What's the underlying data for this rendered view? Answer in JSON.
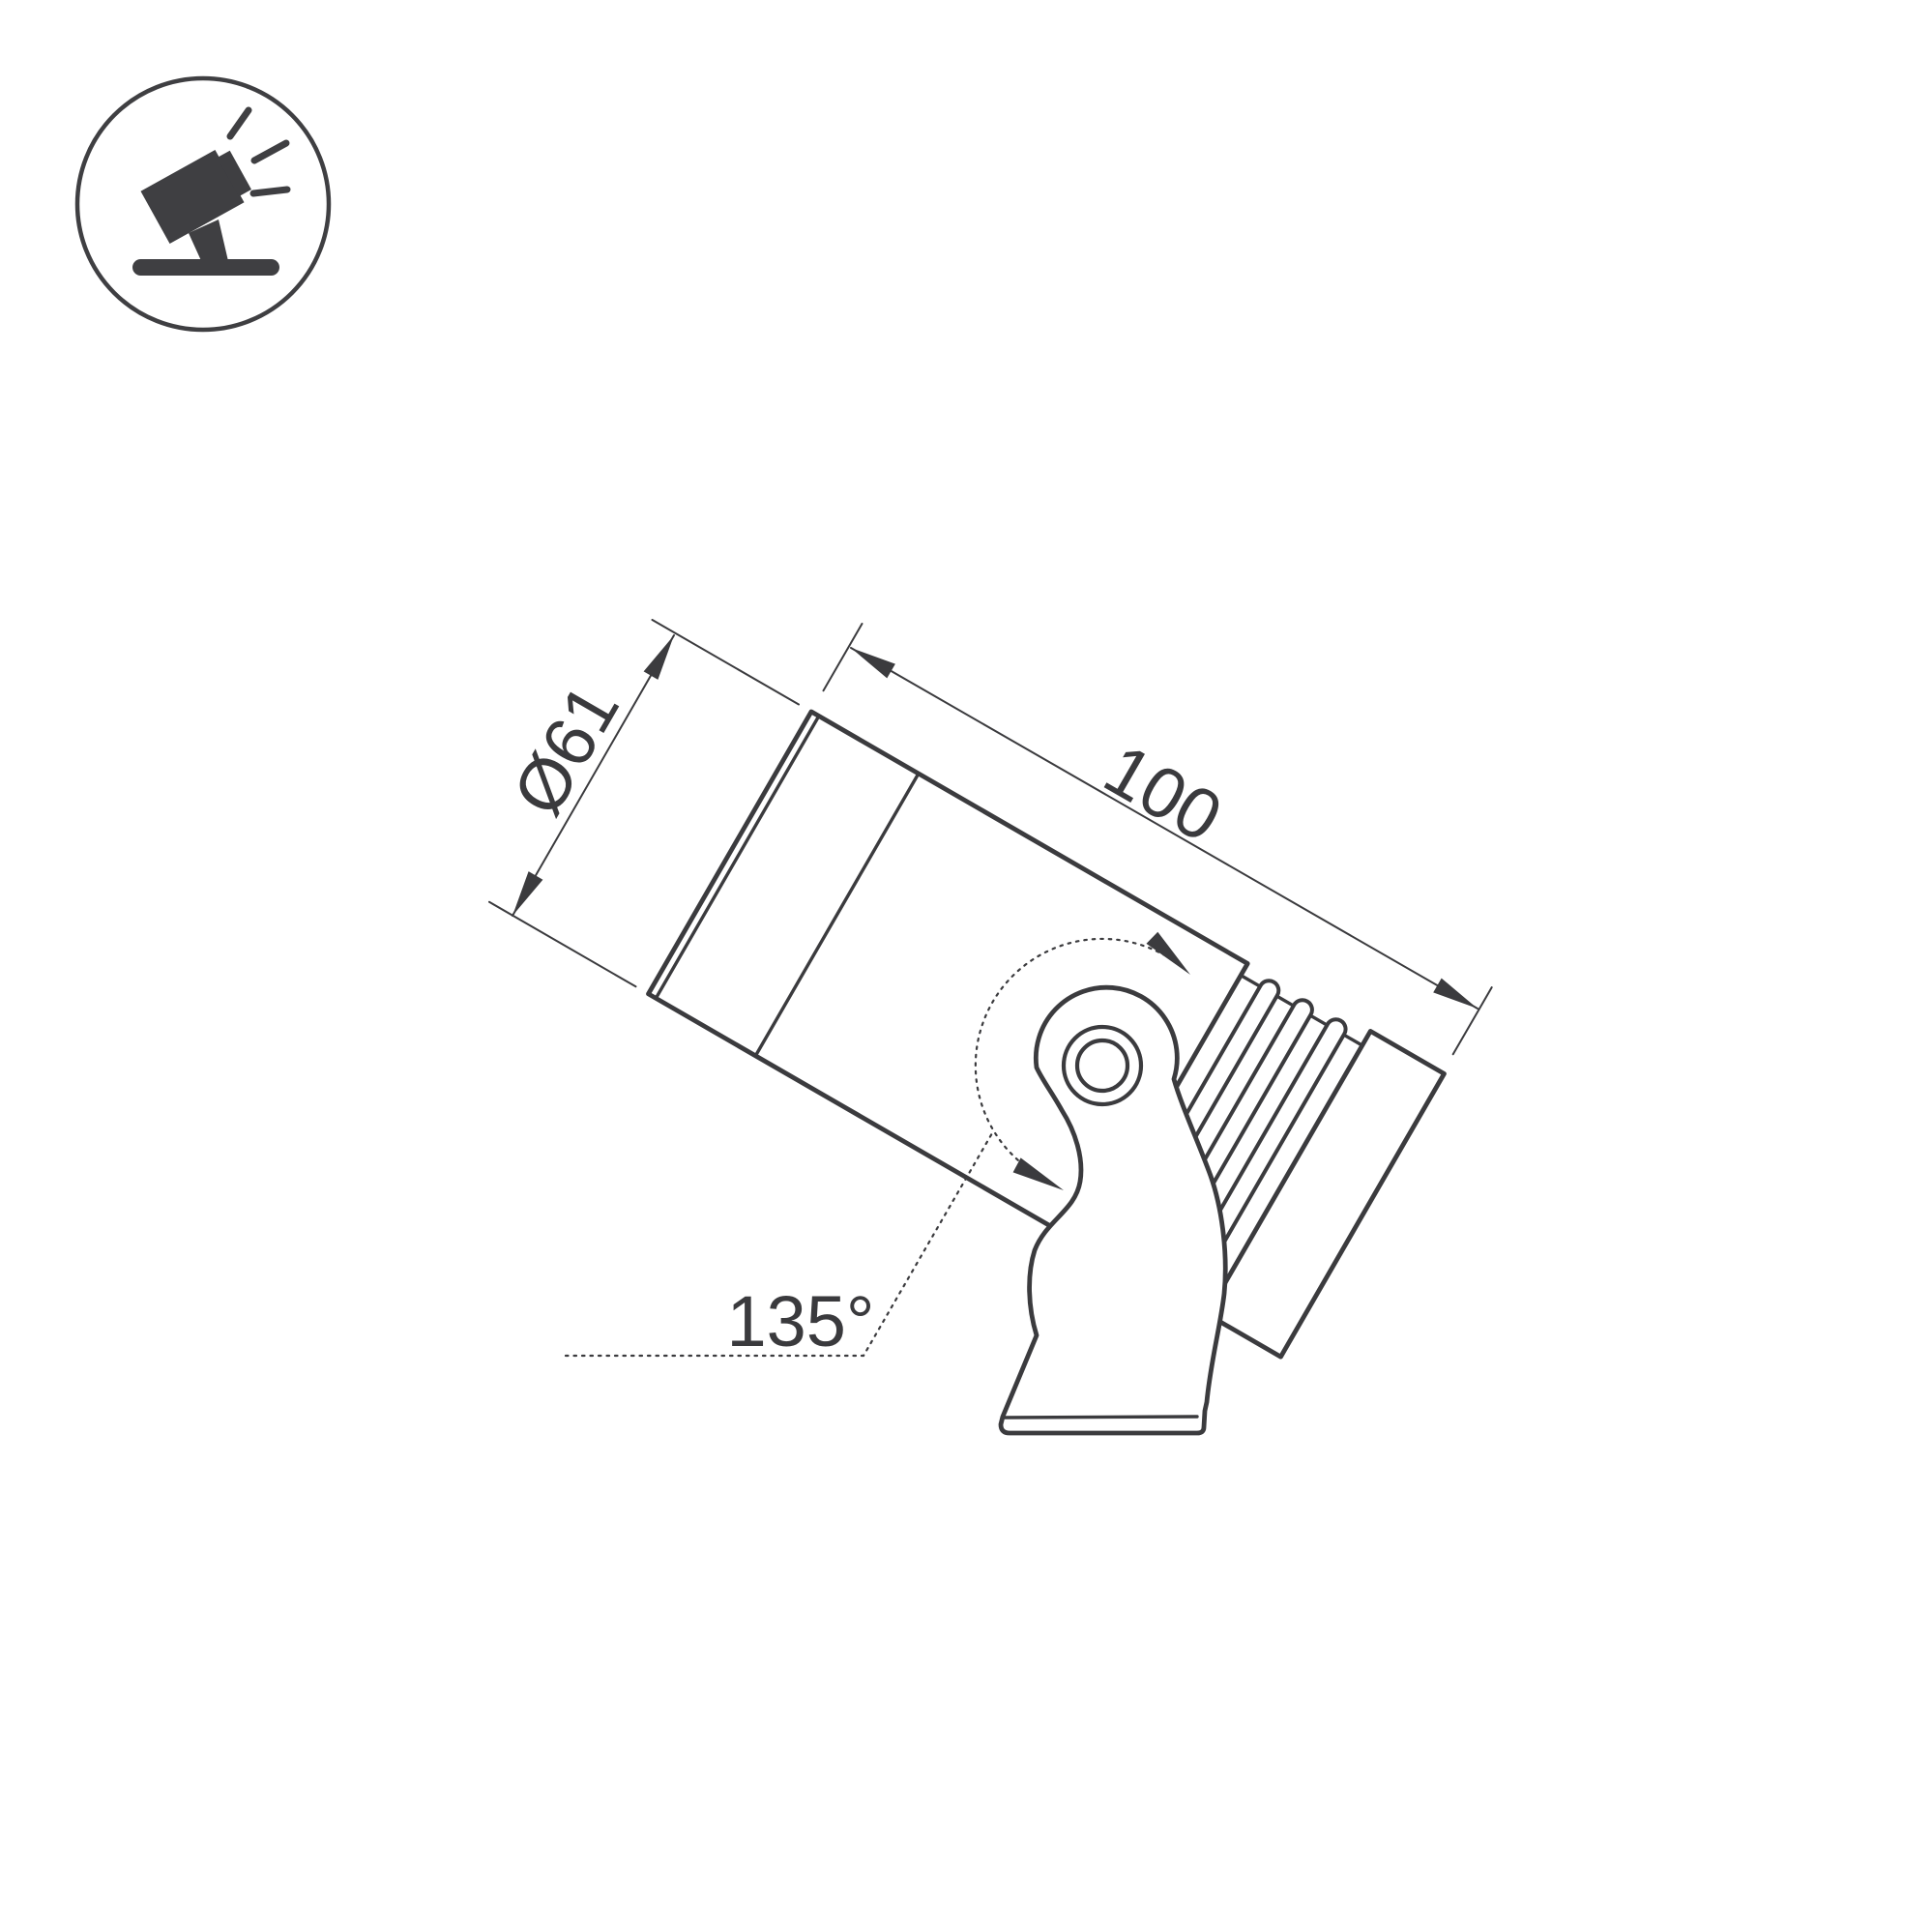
{
  "page": {
    "background": "#ffffff",
    "kind": "technical-dimension-drawing",
    "subject": "adjustable surface spotlight, side view with mounting bracket"
  },
  "badge": {
    "icon": "tilted-spotlight-icon"
  },
  "drawing": {
    "labels": {
      "diameter": "Ø61",
      "length": "100",
      "swivel_angle": "135°"
    },
    "line_color": "#3b3b3e"
  }
}
